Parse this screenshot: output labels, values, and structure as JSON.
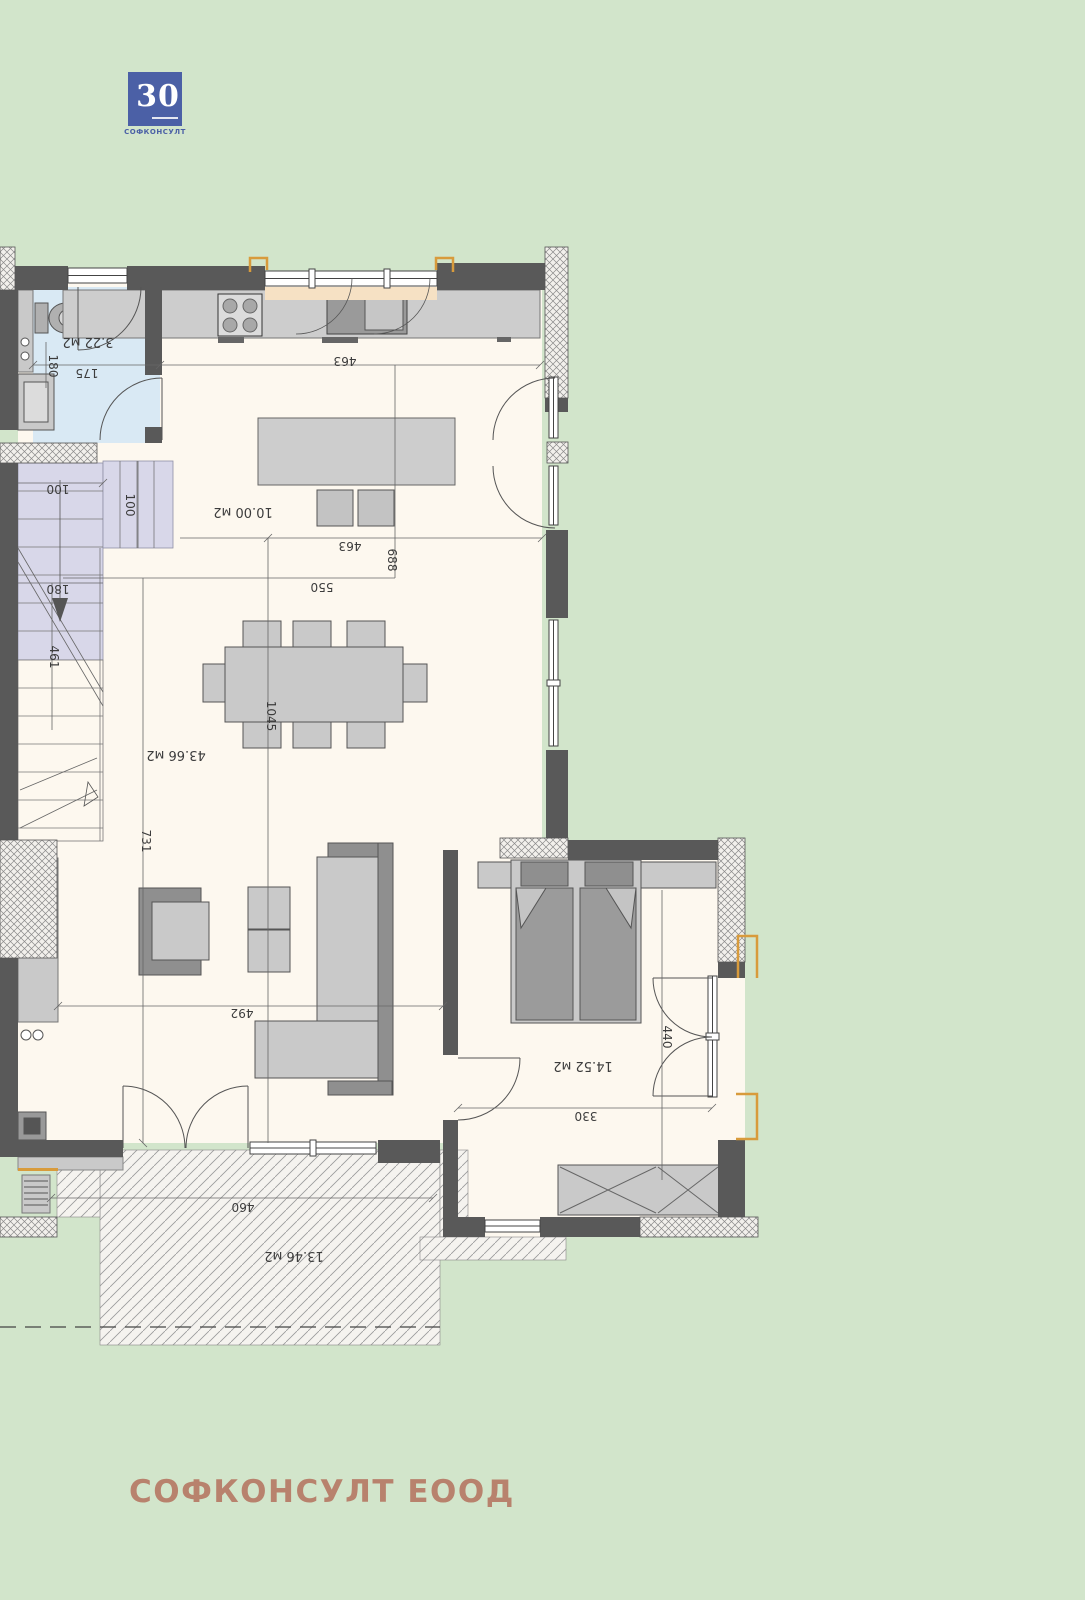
{
  "meta": {
    "background": "#d2e5cb",
    "wall_color": "#595959",
    "floor_color": "#fdf8ef",
    "bath_floor_color": "#d9e9f4",
    "stair_color": "#d8d7e9",
    "accent_orange": "#d89b3c",
    "logo_blue": "#4b60a6",
    "footer_color": "#b8826d"
  },
  "logo": {
    "number": "30",
    "caption": "СОФКОНСУЛТ"
  },
  "footer": {
    "company": "СОФКОНСУЛТ ЕООД"
  },
  "areas": {
    "bathroom": "3.22 м2",
    "kitchen": "10.00 м2",
    "living": "43.66 м2",
    "bedroom": "14.52 м2",
    "terrace": "13.46 м2"
  },
  "dims": {
    "bath_w": "175",
    "bath_h": "180",
    "kitchen_w1": "463",
    "kitchen_w2": "463",
    "island_w": "550",
    "kitchen_d": "688",
    "stair_w": "100",
    "landing_w": "100",
    "stair_d": "180",
    "flight": "461",
    "living_d": "731",
    "living_len": "1045",
    "living_w": "492",
    "bedroom_d": "440",
    "bedroom_w": "330",
    "terrace_w": "460"
  }
}
